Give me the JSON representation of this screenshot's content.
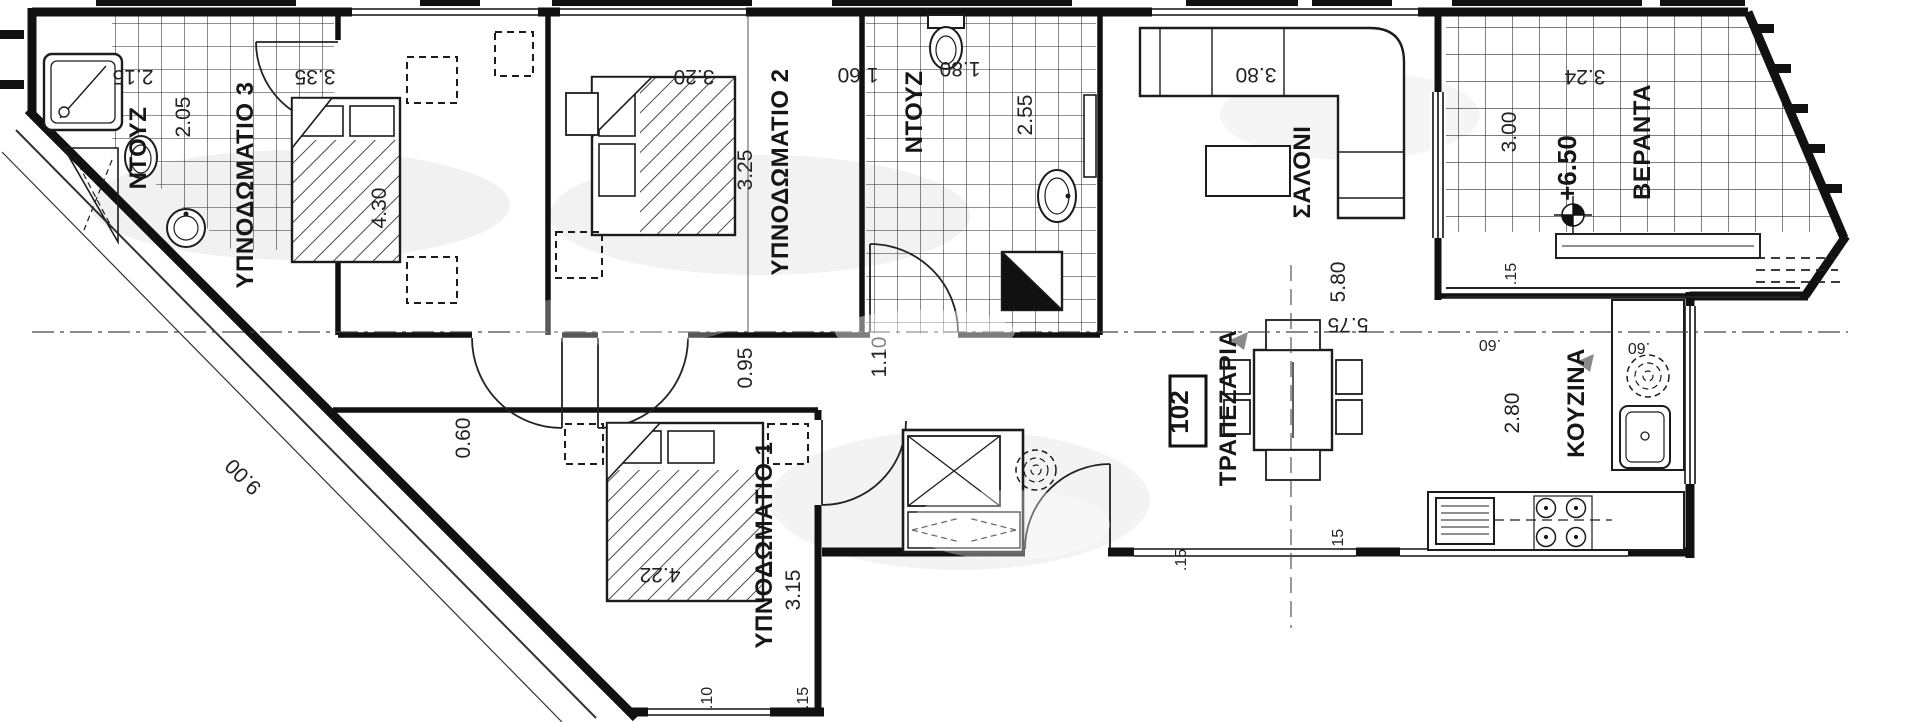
{
  "unit": {
    "number": "102",
    "level": "+6.50"
  },
  "rooms": {
    "bedroom1": "ΥΠΝΟΔΩΜΑΤΙΟ 1",
    "bedroom2": "ΥΠΝΟΔΩΜΑΤΙΟ 2",
    "bedroom3": "ΥΠΝΟΔΩΜΑΤΙΟ 3",
    "bathroom1": "ΝΤΟΥΖ",
    "bathroom2": "ΝΤΟΥΖ",
    "living": "ΣΑΛΟΝΙ",
    "dining": "ΤΡΑΠΕΖΑΡΙΑ",
    "kitchen": "ΚΟΥΖΙΝΑ",
    "veranda": "ΒΕΡΑΝΤΑ"
  },
  "dimensions": {
    "bedroom3": {
      "width": "3.35",
      "length": "4.30"
    },
    "bedroom2": {
      "width": "3.20",
      "length": "3.25",
      "closet": "1.60"
    },
    "bathroom1": {
      "width": "2.15",
      "length": "2.05"
    },
    "bathroom2": {
      "width": "1.80",
      "length": "2.55"
    },
    "living": {
      "sofa_wall": "3.80",
      "length": "5.80",
      "length_inner": "5.75"
    },
    "veranda": {
      "width": "3.24",
      "depth": "3.00",
      "tick": ".15"
    },
    "kitchen": {
      "depth": "2.80",
      "counter": ".60",
      "counter2": ".60"
    },
    "bedroom1": {
      "width": "3.15",
      "length": "4.22",
      "wall": "0.60",
      "sill_a": ".10",
      "sill_b": ".15"
    },
    "hall": {
      "width_a": "0.95",
      "width_b": "1.10"
    },
    "terrace": {
      "tick_a": ".15",
      "tick_b": ".15"
    },
    "plot": {
      "diagonal": "9.00"
    }
  }
}
